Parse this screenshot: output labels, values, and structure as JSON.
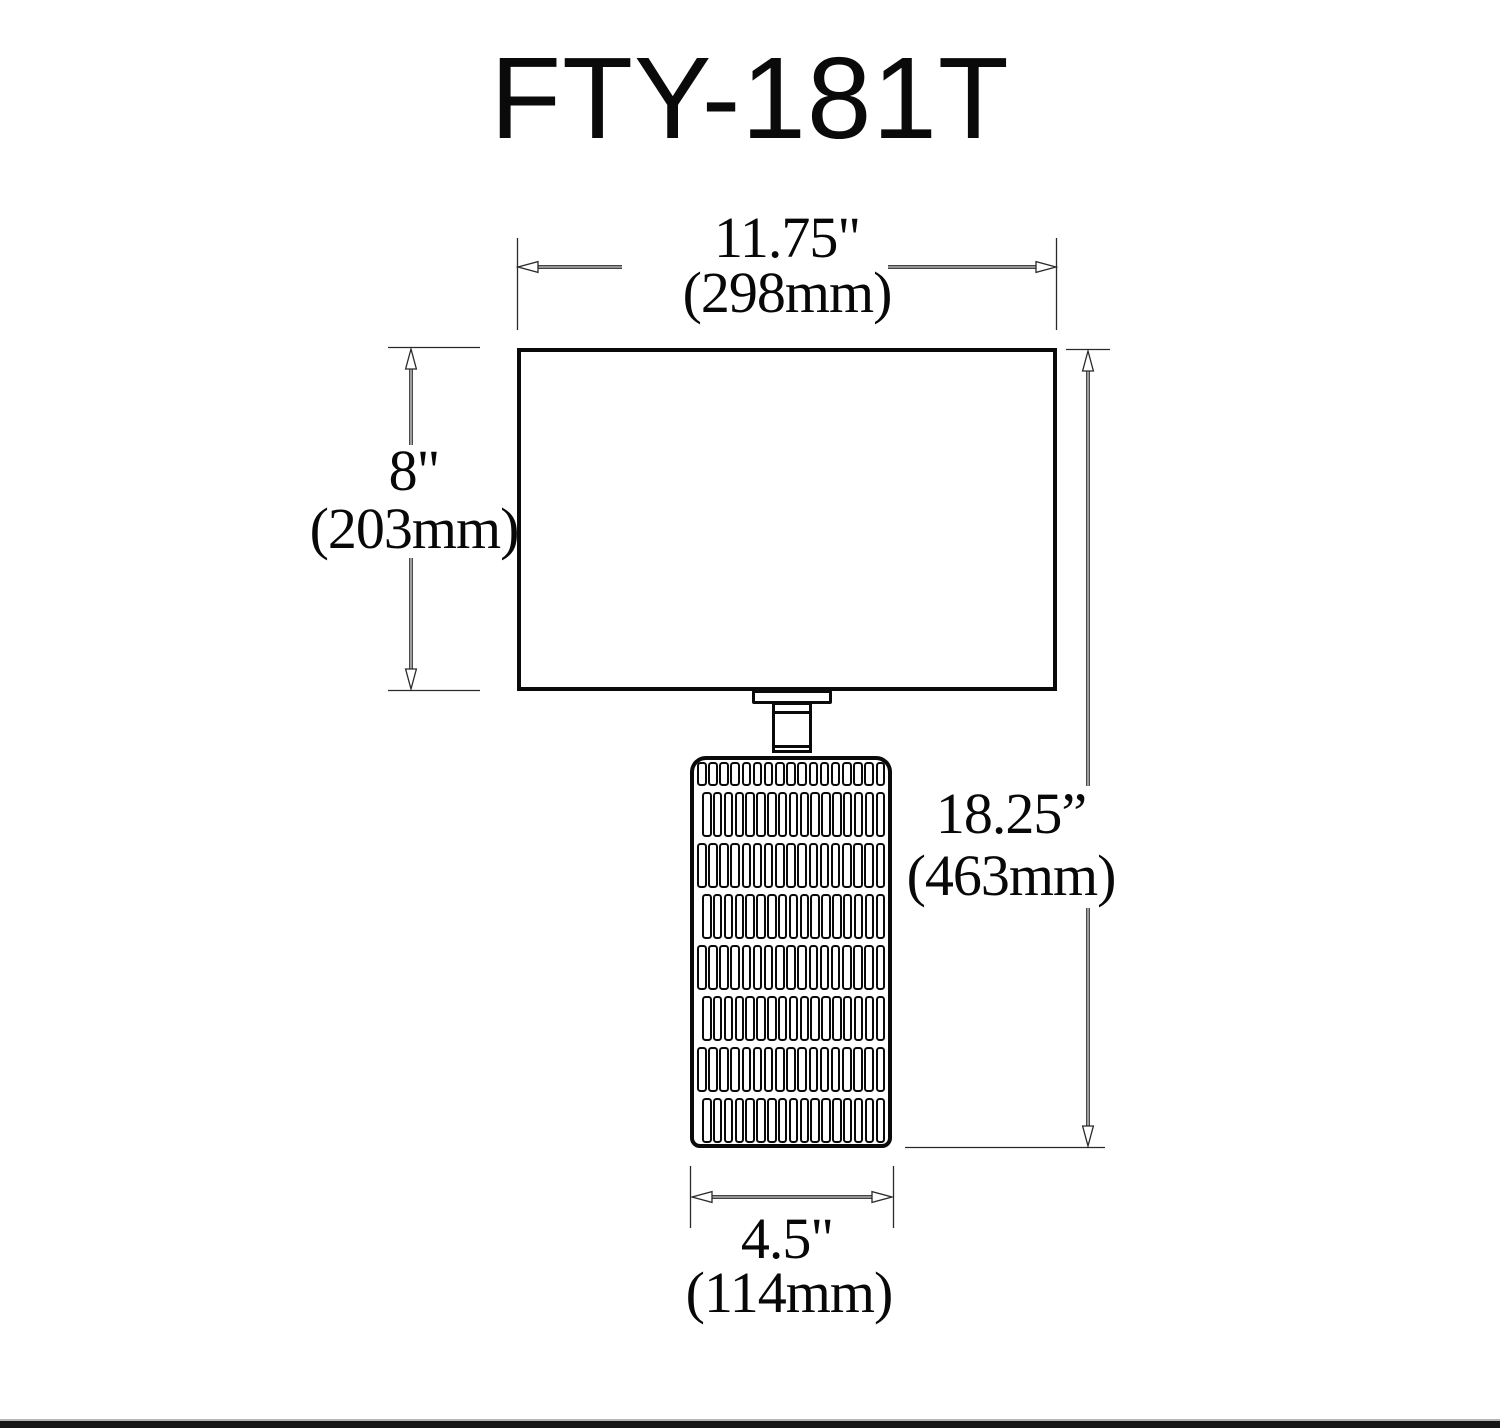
{
  "title": "FTY-181T",
  "dimensions": {
    "shade_width": {
      "inches": "11.75\"",
      "mm": "(298mm)"
    },
    "shade_height": {
      "inches": "8\"",
      "mm": "(203mm)"
    },
    "overall_height": {
      "inches": "18.25”",
      "mm": "(463mm)"
    },
    "base_width": {
      "inches": "4.5\"",
      "mm": "(114mm)"
    }
  },
  "colors": {
    "line": "#1a1a1a",
    "background": "#ffffff"
  },
  "base_pattern": {
    "rows": [
      24,
      45,
      45,
      45,
      45,
      45,
      45,
      45
    ],
    "cells_per_row": 17
  }
}
